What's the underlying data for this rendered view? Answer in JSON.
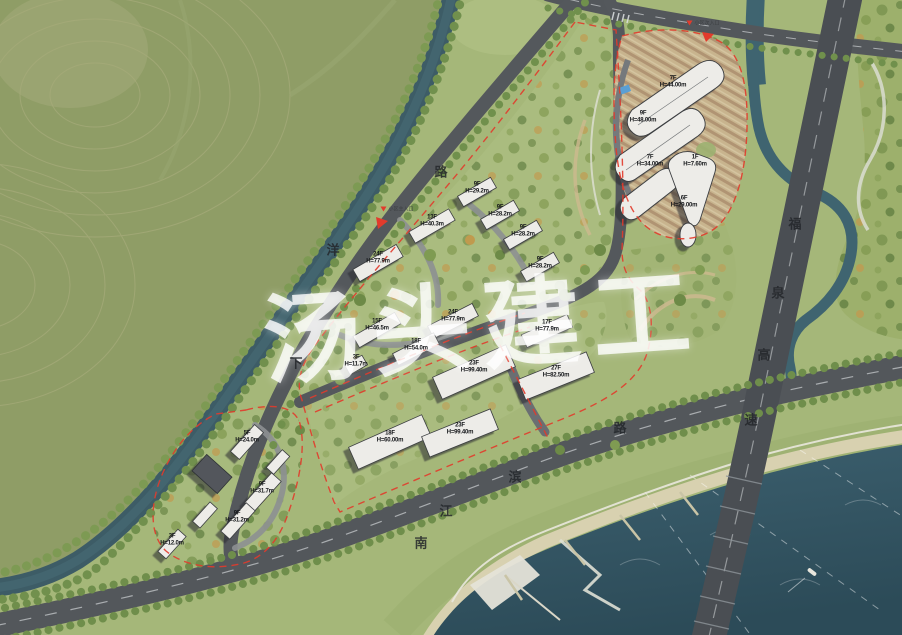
{
  "watermark": {
    "text": "汤头建工"
  },
  "roads": [
    {
      "name": "下洋路",
      "chars": [
        {
          "ch": "下",
          "x": 296,
          "y": 362
        },
        {
          "ch": "洋",
          "x": 333,
          "y": 249
        },
        {
          "ch": "路",
          "x": 441,
          "y": 171
        }
      ]
    },
    {
      "name": "南江滨路",
      "chars": [
        {
          "ch": "南",
          "x": 421,
          "y": 542
        },
        {
          "ch": "江",
          "x": 446,
          "y": 510
        },
        {
          "ch": "滨",
          "x": 515,
          "y": 476
        },
        {
          "ch": "路",
          "x": 620,
          "y": 427
        }
      ]
    },
    {
      "name": "福泉高速",
      "chars": [
        {
          "ch": "福",
          "x": 795,
          "y": 223
        },
        {
          "ch": "泉",
          "x": 778,
          "y": 292
        },
        {
          "ch": "高",
          "x": 764,
          "y": 354
        },
        {
          "ch": "速",
          "x": 751,
          "y": 419
        }
      ]
    }
  ],
  "entrances": [
    {
      "label": "小区主入口",
      "x": 397,
      "y": 209
    },
    {
      "label": "小区次入口",
      "x": 703,
      "y": 23
    }
  ],
  "buildings": [
    {
      "f": "7F",
      "h": "H=44.00m",
      "x": 673,
      "y": 82
    },
    {
      "f": "9F",
      "h": "H=48.00m",
      "x": 643,
      "y": 117
    },
    {
      "f": "7F",
      "h": "H=34.00m",
      "x": 650,
      "y": 161
    },
    {
      "f": "1F",
      "h": "H=7.60m",
      "x": 695,
      "y": 161
    },
    {
      "f": "6F",
      "h": "H=29.00m",
      "x": 684,
      "y": 202
    },
    {
      "f": "9F",
      "h": "H=29.2m",
      "x": 477,
      "y": 188
    },
    {
      "f": "9F",
      "h": "H=28.2m",
      "x": 500,
      "y": 211
    },
    {
      "f": "13F",
      "h": "H=40.3m",
      "x": 432,
      "y": 221
    },
    {
      "f": "9F",
      "h": "H=28.2m",
      "x": 523,
      "y": 231
    },
    {
      "f": "24F",
      "h": "H=77.9m",
      "x": 378,
      "y": 258
    },
    {
      "f": "9F",
      "h": "H=28.2m",
      "x": 540,
      "y": 263
    },
    {
      "f": "15F",
      "h": "H=46.5m",
      "x": 377,
      "y": 325
    },
    {
      "f": "24F",
      "h": "H=77.9m",
      "x": 453,
      "y": 316
    },
    {
      "f": "17F",
      "h": "H=77.9m",
      "x": 547,
      "y": 326
    },
    {
      "f": "18F",
      "h": "H=54.0m",
      "x": 416,
      "y": 345
    },
    {
      "f": "3F",
      "h": "H=11.7m",
      "x": 356,
      "y": 361
    },
    {
      "f": "23F",
      "h": "H=99.40m",
      "x": 474,
      "y": 367
    },
    {
      "f": "27F",
      "h": "H=82.50m",
      "x": 556,
      "y": 372
    },
    {
      "f": "18F",
      "h": "H=60.00m",
      "x": 390,
      "y": 437
    },
    {
      "f": "23F",
      "h": "H=99.40m",
      "x": 460,
      "y": 429
    },
    {
      "f": "5F",
      "h": "H=24.0m",
      "x": 247,
      "y": 437
    },
    {
      "f": "9F",
      "h": "H=31.7m",
      "x": 262,
      "y": 488
    },
    {
      "f": "9F",
      "h": "H=31.2m",
      "x": 237,
      "y": 517
    },
    {
      "f": "3F",
      "h": "H=12.0m",
      "x": 172,
      "y": 540
    }
  ],
  "colors": {
    "hill": "#8f9d66",
    "site_green": "#a5b779",
    "canal": "#3d5c66",
    "river": "#31525f",
    "road": "#54585c",
    "expressway": "#4a4e53",
    "boundary_red": "#e23b2c",
    "building": "#edece8",
    "sand": "#d8d1b0"
  }
}
